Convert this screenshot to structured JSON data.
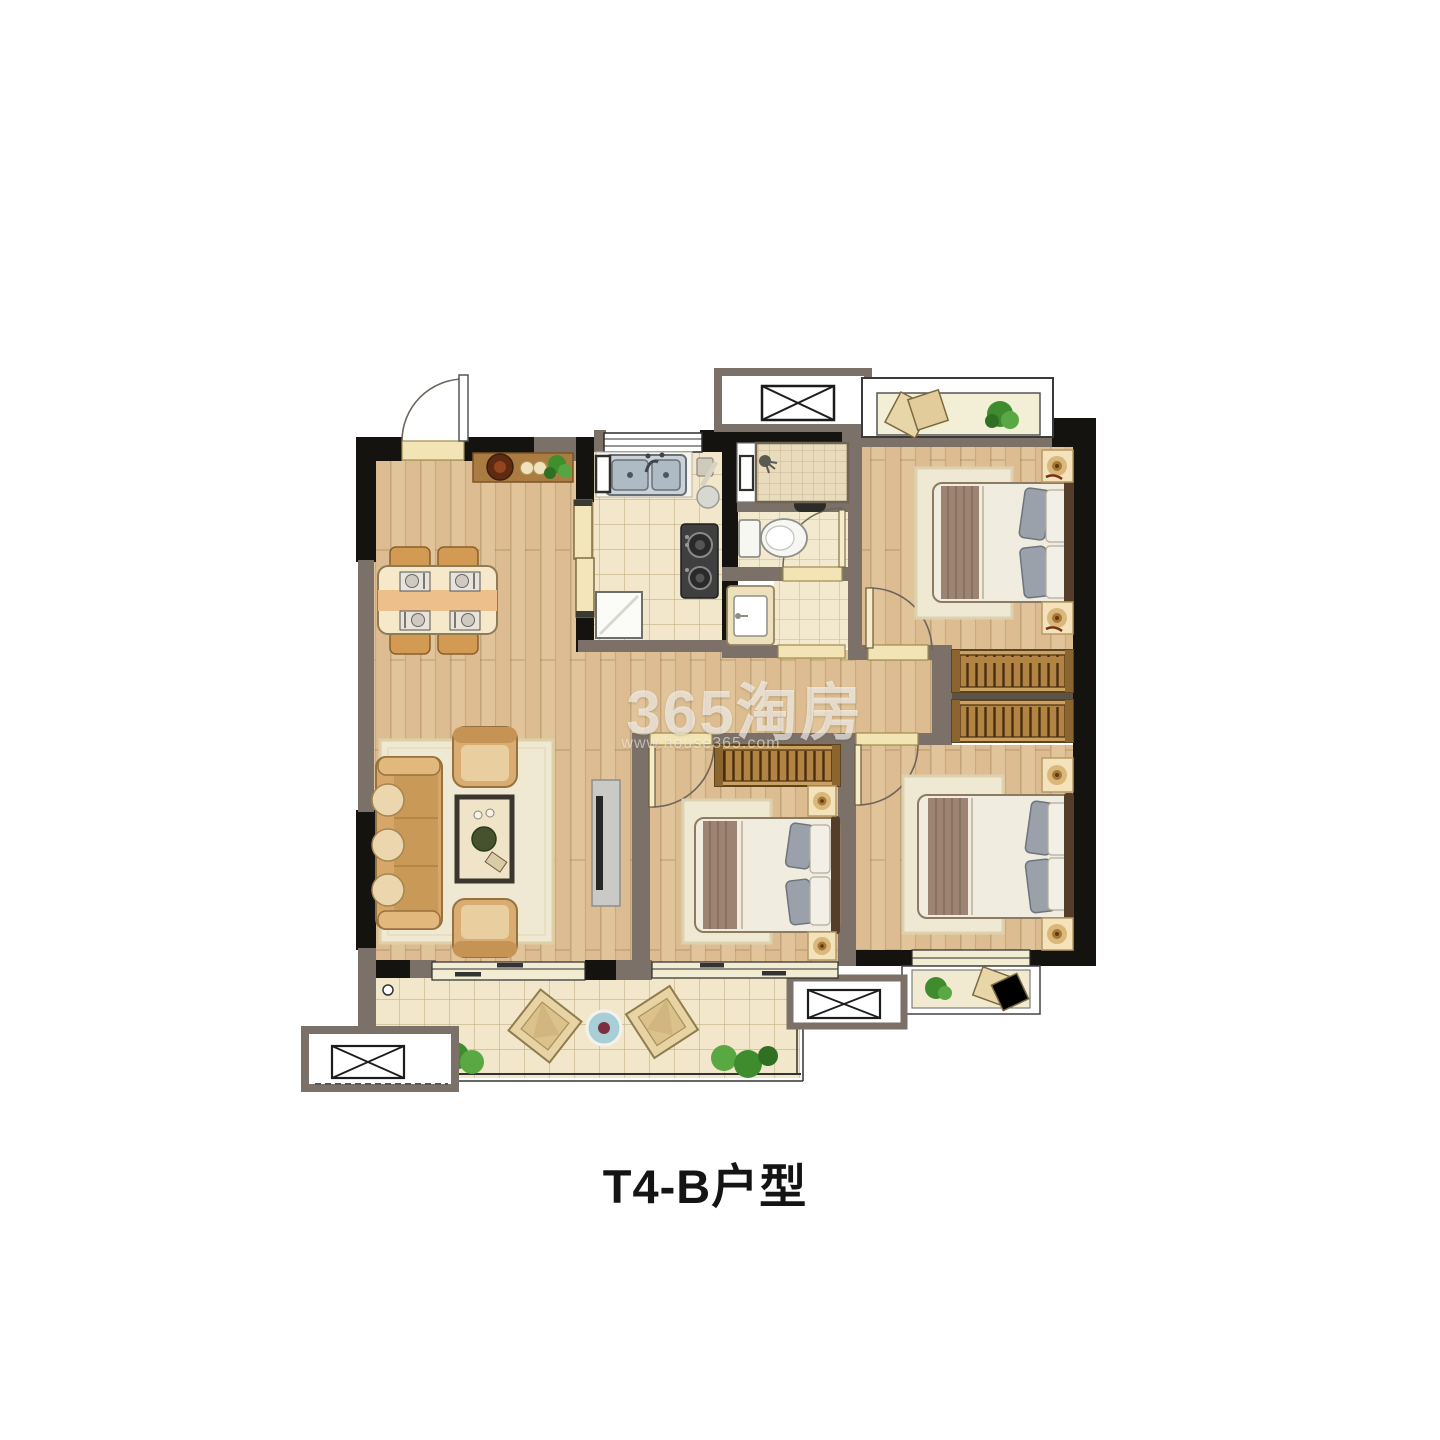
{
  "caption": "T4-B户型",
  "watermark": {
    "text": "365淘房",
    "url": "www.house365.com"
  },
  "palette": {
    "background": "#ffffff",
    "wall_structural": "#151310",
    "wall_partition": "#7b7169",
    "floor_wood": "#dcbc90",
    "floor_tile": "#f2e7ca",
    "threshold_yellow": "#f2e4b4",
    "window_band": "#f2ecd3",
    "rug": "#efe8d2",
    "sofa": "#d7a76a",
    "bed_blanket": "#9d8472",
    "plant_green": "#4e9b3a",
    "caption_color": "#141414",
    "watermark_color": "rgba(255,255,255,0.6)"
  }
}
